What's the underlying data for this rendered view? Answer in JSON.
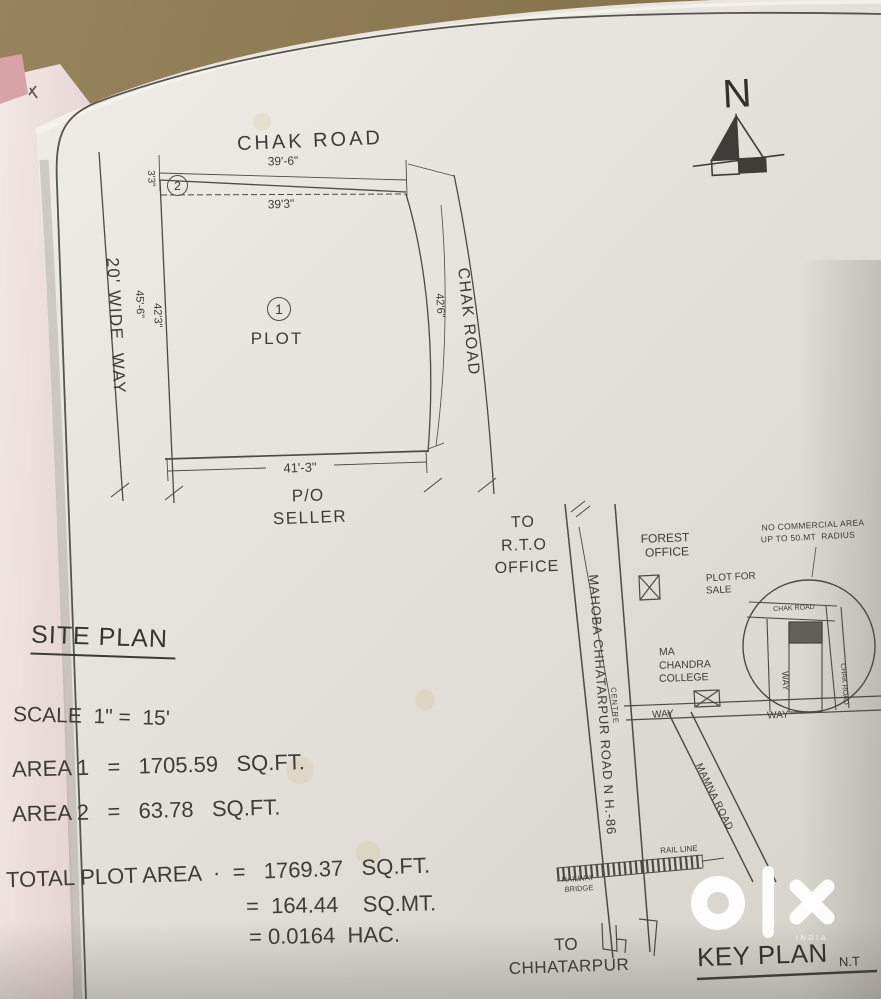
{
  "plot": {
    "road_top": "CHAK ROAD",
    "dim_top_outer": "39'-6\"",
    "dim_top_inner": "39'3\"",
    "dim_left_sliver": "3'3\"",
    "marker_area2": "2",
    "marker_area1": "1",
    "plot_word": "PLOT",
    "way_label": "20' WIDE  WAY",
    "dim_left_outer": "45'-6\"",
    "dim_left_inner": "42'3\"",
    "road_right": "CHAK ROAD",
    "dim_right": "42'6\"",
    "dim_bottom": "41'-3\"",
    "po": "P/O",
    "seller": "SELLER"
  },
  "north": {
    "label": "N"
  },
  "info": {
    "title": "SITE PLAN",
    "scale": "SCALE  1\" =  15'",
    "area1": "AREA 1   =   1705.59   SQ.FT.",
    "area2": "AREA 2   =   63.78   SQ.FT.",
    "total": "TOTAL PLOT AREA  ·  =   1769.37   SQ.FT.",
    "total_sqmt": "=  164.44    SQ.MT.",
    "total_hac": "= 0.0164  HAC."
  },
  "key_plan": {
    "to_rto_1": "TO",
    "to_rto_2": "R.T.O",
    "to_rto_3": "OFFICE",
    "forest_1": "FOREST",
    "forest_2": "OFFICE",
    "no_commercial_1": "NO COMMERCIAL AREA",
    "no_commercial_2": "UP TO 50.MT  RADIUS",
    "plot_for_sale_1": "PLOT FOR",
    "plot_for_sale_2": "SALE",
    "chak_road_top": "CHAK ROAD",
    "way_vertical": "WAY",
    "chak_road_right": "CHAK ROAD",
    "way_left": "WAY",
    "way_mid": "WAY",
    "college_1": "MA",
    "college_2": "CHANDRA",
    "college_3": "COLLEGE",
    "highway": "MAHOBA CHHATARPUR ROAD N H.-86",
    "centre": "CENTRE",
    "mamna_road": "MAMNA ROAD",
    "rail_line": "RAIL LINE",
    "railway_bridge_1": "RAILWAY",
    "railway_bridge_2": "BRIDGE",
    "to_chhatarpur_1": "TO",
    "to_chhatarpur_2": "CHHATARPUR",
    "title": "KEY PLAN",
    "nts": "N.T"
  },
  "watermark": {
    "brand_sub": "INDIA"
  },
  "colors": {
    "paper": "#e7e4de",
    "ink": "#4c4a46",
    "background_table": "#8a774f",
    "side_page_pink": "#e8cfcd",
    "watermark_white": "#ffffff"
  }
}
